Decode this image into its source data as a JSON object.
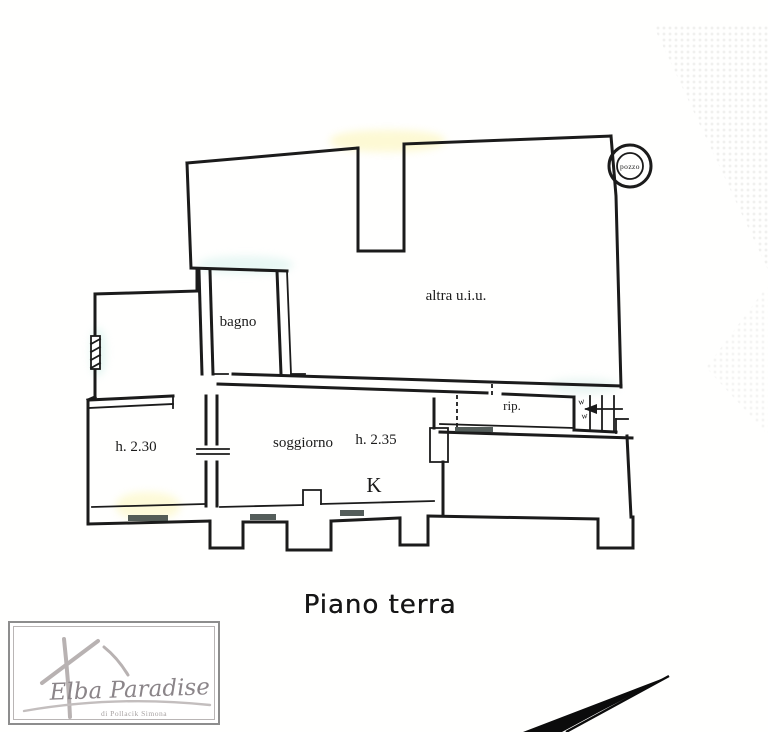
{
  "plan": {
    "caption": "Piano terra",
    "rooms": {
      "bagno": "bagno",
      "altra_uiu": "altra u.i.u.",
      "rip": "rip.",
      "h_left": "h. 2.30",
      "soggiorno": "soggiorno",
      "h_main": "h. 2.35",
      "kitchen": "K",
      "pozzo": "pozzo",
      "stair_mark_1": "w",
      "stair_mark_2": "w"
    }
  },
  "logo": {
    "title": "Elba Paradise",
    "subtitle": "di Pollacik Simona"
  },
  "colors": {
    "ink": "#1d1d1d",
    "paper": "#fffffe",
    "window_fill": "#2f3b37",
    "logo_text": "#8b8589",
    "logo_border": "#8d8d8d",
    "north_arrow": "#0e0e0e"
  }
}
